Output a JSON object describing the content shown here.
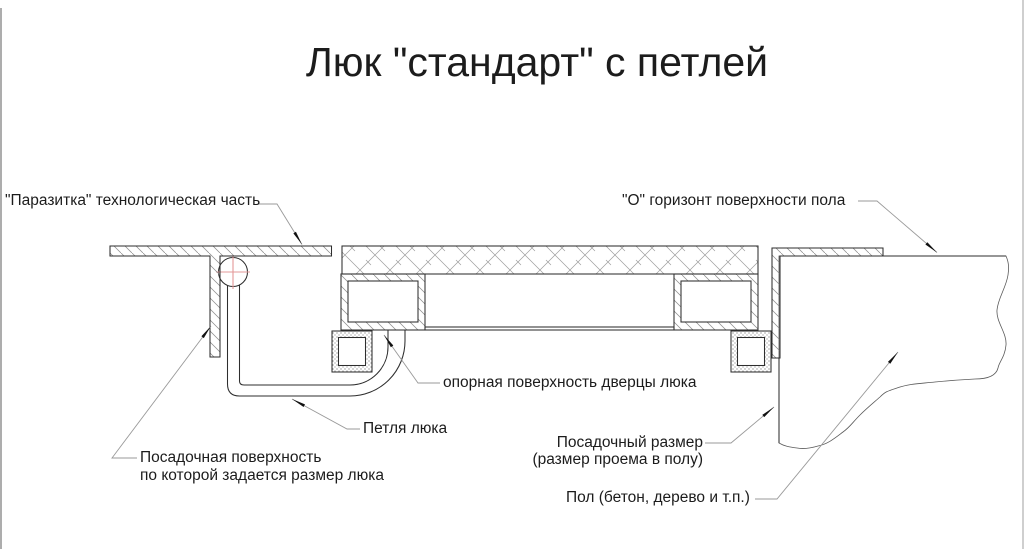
{
  "title": "Люк \"стандарт\" с петлей",
  "labels": {
    "parasitka": "\"Паразитка\" технологическая часть",
    "floor_horizon": "\"О\" горизонт поверхности пола",
    "door_support_surface": "опорная поверхность дверцы люка",
    "hinge": "Петля люка",
    "seating_surface": {
      "line1": "Посадочная поверхность",
      "line2": "по которой задается размер люка"
    },
    "opening_size": {
      "line1": "Посадочный размер",
      "line2": "(размер проема в полу)"
    },
    "floor_material": "Пол (бетон, дерево и т.п.)"
  },
  "colors": {
    "ink": "#1c1c1c",
    "drawing_line": "#2e2e2e",
    "hatch_line": "#8a8a8a",
    "leader_line": "#9a9a9a",
    "hinge_axis_crosshair": "#e39898",
    "background": "#ffffff"
  }
}
